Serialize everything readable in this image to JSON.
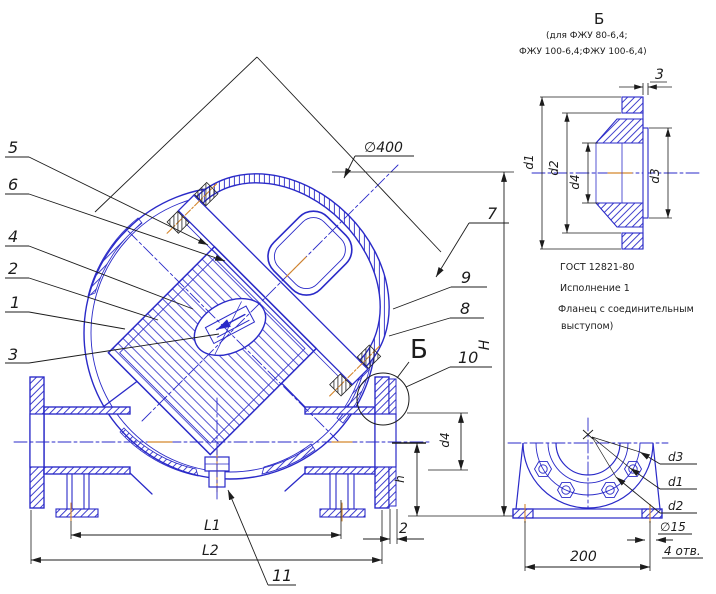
{
  "drawing": {
    "callouts": {
      "c1": "1",
      "c2": "2",
      "c3": "3",
      "c4": "4",
      "c5": "5",
      "c6": "6",
      "c7": "7",
      "c8": "8",
      "c9": "9",
      "c10": "10",
      "c11": "11"
    },
    "detail_marker": "Б",
    "dims_main": {
      "dia400": "∅400",
      "H": "H",
      "h": "h",
      "d4": "d4",
      "L1": "L1",
      "L2": "L2",
      "gap2": "2"
    },
    "view_b": {
      "title": "Б",
      "cond1": "(для ФЖУ 80-6,4;",
      "cond2": "ФЖУ 100-6,4;ФЖУ 100-6,4)",
      "dims": {
        "d1": "d1",
        "d2": "d2",
        "d3": "d3",
        "d4": "d4",
        "t3": "3"
      },
      "note1": "ГОСТ 12821-80",
      "note2": "Исполнение 1",
      "note3": "Фланец с соединительным",
      "note4": "выступом)"
    },
    "view_front": {
      "dims": {
        "d3": "d3",
        "d1": "d1",
        "d2": "d2",
        "dia15": "∅15",
        "holes": "4 отв.",
        "w200": "200"
      }
    },
    "colors": {
      "line": "#2a2ac8",
      "accent": "#d4862c",
      "dim": "#1c1c1c"
    }
  }
}
